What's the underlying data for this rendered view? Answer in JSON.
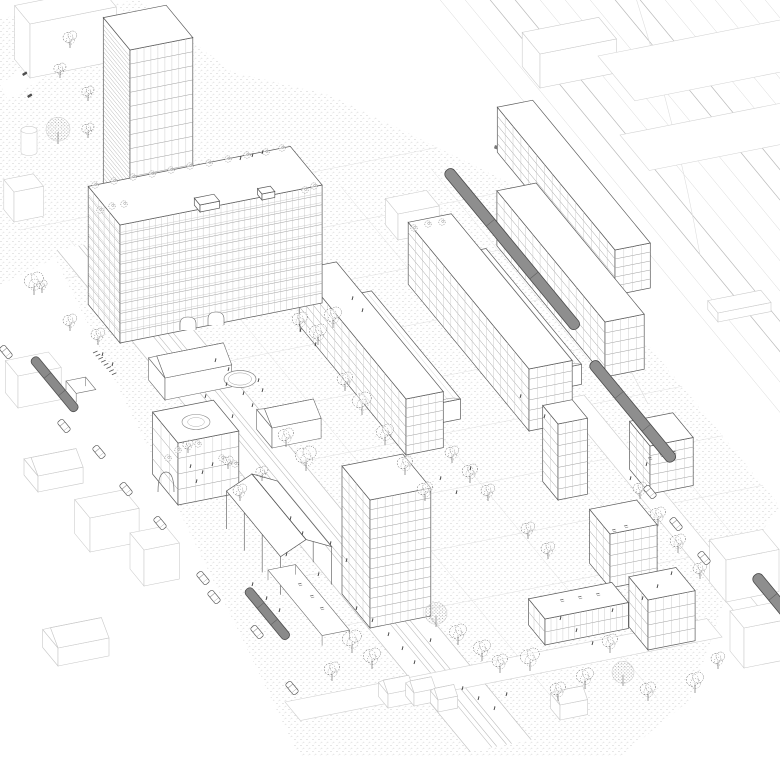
{
  "colors": {
    "background": "#ffffff",
    "ink": "#4a4a4a",
    "grid_ink": "#a8a8a8",
    "light_ink": "#c9c9c9",
    "ground_dot": "#bdbdbd",
    "vehicle_fill": "#8e8e8e",
    "vehicle_edge": "#4a4a4a",
    "tree_ink": "#565656"
  },
  "scene": {
    "ground": {
      "site_polygon": "0,18 140,0 232,72 330,95 520,188 780,506 735,570 690,700 620,757 300,757 55,258 0,285",
      "rail_count": 14,
      "rail_x0": 432,
      "rail_spacing": 25
    },
    "buildings": [
      {
        "n": "context-building-nw",
        "t": "box",
        "f": [
          30,
          78
        ],
        "a": 88,
        "b": 24,
        "h": 54,
        "ctx": 1
      },
      {
        "n": "context-silo",
        "t": "cyl",
        "f": [
          29,
          152
        ],
        "r": 8,
        "h": 22,
        "ctx": 1
      },
      {
        "n": "context-building-w1",
        "t": "box",
        "f": [
          14,
          222
        ],
        "a": 30,
        "b": 16,
        "h": 30,
        "ctx": 1
      },
      {
        "n": "context-building-w2",
        "t": "box",
        "f": [
          18,
          408
        ],
        "a": 44,
        "b": 20,
        "h": 32,
        "ctx": 1
      },
      {
        "n": "context-house-w",
        "t": "gable",
        "f": [
          38,
          492
        ],
        "a": 46,
        "b": 22,
        "h": 16,
        "rise": 10,
        "ctx": 1
      },
      {
        "n": "context-house-sw",
        "t": "gable",
        "f": [
          58,
          666
        ],
        "a": 52,
        "b": 24,
        "h": 18,
        "rise": 11,
        "ctx": 1
      },
      {
        "n": "context-building-s1",
        "t": "box",
        "f": [
          90,
          552
        ],
        "a": 50,
        "b": 24,
        "h": 34,
        "ctx": 1
      },
      {
        "n": "context-building-s2",
        "t": "box",
        "f": [
          144,
          586
        ],
        "a": 36,
        "b": 22,
        "h": 36,
        "ctx": 1
      },
      {
        "n": "context-building-n",
        "t": "box",
        "f": [
          398,
          240
        ],
        "a": 42,
        "b": 20,
        "h": 26,
        "ctx": 1
      },
      {
        "n": "context-building-ne1",
        "t": "box",
        "f": [
          540,
          88
        ],
        "a": 78,
        "b": 28,
        "h": 34,
        "ctx": 1
      },
      {
        "n": "context-roof-ne1",
        "t": "flat",
        "f": [
          598,
          56
        ],
        "a": 215,
        "b": 58,
        "ctx": 1
      },
      {
        "n": "context-roof-ne2",
        "t": "flat",
        "f": [
          620,
          135
        ],
        "a": 170,
        "b": 46,
        "ctx": 1
      },
      {
        "n": "railway-platform",
        "t": "box",
        "f": [
          718,
          322
        ],
        "a": 54,
        "b": 16,
        "h": 9,
        "ctx": 1
      },
      {
        "n": "context-building-e1",
        "t": "box",
        "f": [
          726,
          602
        ],
        "a": 54,
        "b": 26,
        "h": 42,
        "ctx": 1
      },
      {
        "n": "context-building-e2",
        "t": "box",
        "f": [
          744,
          668
        ],
        "a": 44,
        "b": 22,
        "h": 40,
        "ctx": 1
      },
      {
        "n": "context-house-s1",
        "t": "gable",
        "f": [
          388,
          708
        ],
        "a": 26,
        "b": 15,
        "h": 14,
        "rise": 8,
        "ctx": 1
      },
      {
        "n": "context-house-s2",
        "t": "gable",
        "f": [
          414,
          706
        ],
        "a": 22,
        "b": 13,
        "h": 13,
        "rise": 7,
        "ctx": 1
      },
      {
        "n": "context-house-s3",
        "t": "gable",
        "f": [
          438,
          712
        ],
        "a": 20,
        "b": 12,
        "h": 12,
        "rise": 7,
        "ctx": 1
      },
      {
        "n": "context-house-s4",
        "t": "gable",
        "f": [
          560,
          720
        ],
        "a": 28,
        "b": 15,
        "h": 15,
        "rise": 8,
        "ctx": 1
      },
      {
        "n": "slab-d-building",
        "t": "box",
        "f": [
          615,
          295
        ],
        "a": 36,
        "b": 185,
        "h": 45,
        "fl": 5,
        "cw": 9
      },
      {
        "n": "slab-c-building",
        "t": "box",
        "f": [
          605,
          377
        ],
        "a": 40,
        "b": 170,
        "h": 55,
        "fl": 5,
        "cw": 8
      },
      {
        "n": "vault-hall-bc",
        "t": "vault",
        "f": [
          558,
          389
        ],
        "a": 24,
        "b": 150,
        "h": 20
      },
      {
        "n": "slab-b-building",
        "t": "box",
        "f": [
          529,
          431
        ],
        "a": 44,
        "b": 190,
        "h": 62,
        "fl": 6,
        "cw": 8
      },
      {
        "n": "vault-hall-ab",
        "t": "vault",
        "f": [
          435,
          424
        ],
        "a": 26,
        "b": 140,
        "h": 20
      },
      {
        "n": "slab-a-building",
        "t": "box",
        "f": [
          406,
          455
        ],
        "a": 38,
        "b": 168,
        "h": 56,
        "fl": 6,
        "cw": 8
      },
      {
        "n": "highrise-tower",
        "t": "box",
        "f": [
          130,
          318
        ],
        "a": 64,
        "b": 42,
        "h": 268,
        "fl": 19,
        "cw": 7,
        "bandsL": 4.5
      },
      {
        "n": "midrise-slab-building",
        "t": "box",
        "f": [
          120,
          343
        ],
        "a": 206,
        "b": 50,
        "h": 118,
        "fl": 12,
        "cw": 6,
        "band": 1
      },
      {
        "n": "existing-hall-1",
        "t": "gable",
        "f": [
          165,
          400
        ],
        "a": 68,
        "b": 26,
        "h": 22,
        "rise": 12
      },
      {
        "n": "existing-hall-2",
        "t": "gable",
        "f": [
          272,
          448
        ],
        "a": 50,
        "b": 24,
        "h": 20,
        "rise": 10
      },
      {
        "n": "courtyard-building",
        "t": "box",
        "f": [
          178,
          505
        ],
        "a": 62,
        "b": 40,
        "h": 62,
        "fl": 4,
        "cw": 9
      },
      {
        "n": "block-c2-building",
        "t": "box",
        "f": [
          650,
          494
        ],
        "a": 44,
        "b": 32,
        "h": 48,
        "fl": 5,
        "cw": 8
      },
      {
        "n": "block-g2-building",
        "t": "box",
        "f": [
          558,
          500
        ],
        "a": 30,
        "b": 24,
        "h": 76,
        "fl": 7,
        "cw": 8
      },
      {
        "n": "block-g1-building",
        "t": "box",
        "f": [
          610,
          588
        ],
        "a": 48,
        "b": 32,
        "h": 54,
        "fl": 5,
        "cw": 8
      },
      {
        "n": "plaza-tower-building",
        "t": "box",
        "f": [
          370,
          628
        ],
        "a": 62,
        "b": 44,
        "h": 128,
        "fl": 13,
        "cw": 8
      },
      {
        "n": "low-hall-building",
        "t": "box",
        "f": [
          545,
          645
        ],
        "a": 85,
        "b": 26,
        "h": 26,
        "fl": 2,
        "cw": 6
      },
      {
        "n": "cube-building-se",
        "t": "box",
        "f": [
          648,
          650
        ],
        "a": 48,
        "b": 30,
        "h": 50,
        "fl": 4,
        "cw": 8
      },
      {
        "n": "roof-structure-1",
        "t": "box",
        "f": [
          200,
          212
        ],
        "a": 20,
        "b": 9,
        "h": 7
      },
      {
        "n": "roof-structure-2",
        "t": "box",
        "f": [
          262,
          200
        ],
        "a": 13,
        "b": 7,
        "h": 6
      }
    ],
    "details": {
      "fountain": {
        "cx": 240,
        "cy": 379,
        "rx": 16,
        "ry": 8.5
      },
      "roof_circle": {
        "cx": 196,
        "cy": 422,
        "rx": 14,
        "ry": 7.5
      },
      "arches": [
        [
          188,
          330
        ],
        [
          216,
          325
        ]
      ],
      "big_arch": {
        "x": 166,
        "y": 492
      },
      "pavilion": {
        "r0": [
          252,
          474
        ],
        "len": 85,
        "half": 26,
        "drop": 12,
        "colh": 38
      },
      "canopy": {
        "o": [
          268,
          560
        ],
        "a": 28,
        "b": 85
      },
      "tram_stop": {
        "o": [
          66,
          372
        ]
      },
      "bike_racks": {
        "x": 93,
        "y": 353,
        "count": 8
      },
      "signals": [
        [
          495,
          145
        ],
        [
          508,
          153
        ]
      ],
      "small_marks": [
        [
          22,
          74
        ],
        [
          27,
          96
        ]
      ]
    },
    "trains": [
      {
        "x": 447,
        "y": 170,
        "len": 205
      },
      {
        "x": 592,
        "y": 362,
        "len": 128
      },
      {
        "x": 755,
        "y": 575,
        "len": 85
      }
    ],
    "trams": [
      {
        "x": 33,
        "y": 358,
        "len": 68
      },
      {
        "x": 247,
        "y": 589,
        "len": 64
      }
    ],
    "cars": [
      [
        6,
        352
      ],
      [
        64,
        426
      ],
      [
        99,
        452
      ],
      [
        126,
        489
      ],
      [
        160,
        523
      ],
      [
        203,
        578
      ],
      [
        214,
        597
      ],
      [
        257,
        632
      ],
      [
        292,
        688
      ],
      [
        650,
        492
      ],
      [
        676,
        524
      ],
      [
        704,
        558
      ]
    ],
    "trees": [
      [
        70,
        47,
        8,
        "s"
      ],
      [
        60,
        77,
        7,
        "s"
      ],
      [
        88,
        100,
        7,
        "s"
      ],
      [
        58,
        143,
        12,
        "d"
      ],
      [
        88,
        137,
        7,
        "s"
      ],
      [
        42,
        292,
        6,
        "s"
      ],
      [
        34,
        294,
        11,
        "s"
      ],
      [
        70,
        330,
        8,
        "s"
      ],
      [
        98,
        344,
        8,
        "s"
      ],
      [
        300,
        330,
        9,
        "s"
      ],
      [
        318,
        344,
        10,
        "s"
      ],
      [
        333,
        327,
        10,
        "s"
      ],
      [
        345,
        390,
        9,
        "s"
      ],
      [
        362,
        414,
        11,
        "s"
      ],
      [
        385,
        444,
        10,
        "s"
      ],
      [
        405,
        474,
        9,
        "s"
      ],
      [
        425,
        500,
        9,
        "s"
      ],
      [
        306,
        470,
        12,
        "s"
      ],
      [
        286,
        446,
        9,
        "s"
      ],
      [
        262,
        480,
        7,
        "s"
      ],
      [
        240,
        500,
        8,
        "s"
      ],
      [
        452,
        462,
        8,
        "s"
      ],
      [
        470,
        482,
        9,
        "s"
      ],
      [
        488,
        500,
        8,
        "s"
      ],
      [
        352,
        652,
        11,
        "s"
      ],
      [
        332,
        680,
        9,
        "s"
      ],
      [
        372,
        668,
        10,
        "s"
      ],
      [
        436,
        626,
        11,
        "d"
      ],
      [
        458,
        644,
        10,
        "s"
      ],
      [
        482,
        660,
        10,
        "s"
      ],
      [
        500,
        672,
        9,
        "s"
      ],
      [
        530,
        670,
        11,
        "s"
      ],
      [
        558,
        700,
        9,
        "s"
      ],
      [
        585,
        688,
        10,
        "s"
      ],
      [
        610,
        652,
        9,
        "s"
      ],
      [
        623,
        685,
        11,
        "d"
      ],
      [
        648,
        700,
        9,
        "s"
      ],
      [
        695,
        692,
        10,
        "s"
      ],
      [
        718,
        668,
        8,
        "s"
      ],
      [
        658,
        525,
        9,
        "s"
      ],
      [
        678,
        552,
        9,
        "s"
      ],
      [
        700,
        578,
        8,
        "s"
      ],
      [
        640,
        498,
        8,
        "s"
      ],
      [
        528,
        538,
        8,
        "s"
      ],
      [
        548,
        558,
        8,
        "s"
      ],
      [
        188,
        452,
        6,
        "s"
      ],
      [
        228,
        468,
        6,
        "s"
      ]
    ],
    "shrubs": [
      [
        95,
        185
      ],
      [
        114,
        181
      ],
      [
        133,
        177
      ],
      [
        152,
        174
      ],
      [
        171,
        170
      ],
      [
        190,
        166
      ],
      [
        209,
        163
      ],
      [
        228,
        159
      ],
      [
        247,
        155
      ],
      [
        266,
        152
      ],
      [
        282,
        148
      ],
      [
        100,
        210
      ],
      [
        112,
        206
      ],
      [
        124,
        204
      ],
      [
        305,
        190
      ],
      [
        314,
        186
      ],
      [
        168,
        458
      ],
      [
        178,
        450
      ],
      [
        198,
        444
      ],
      [
        222,
        458
      ],
      [
        235,
        464
      ],
      [
        414,
        228
      ],
      [
        428,
        224
      ],
      [
        442,
        222
      ]
    ],
    "roof_marks": [
      [
        648,
        458
      ],
      [
        660,
        455
      ],
      [
        672,
        452
      ],
      [
        612,
        530
      ],
      [
        624,
        526
      ],
      [
        560,
        600
      ],
      [
        578,
        597
      ],
      [
        596,
        594
      ],
      [
        298,
        584
      ],
      [
        310,
        596
      ],
      [
        320,
        608
      ]
    ],
    "people": [
      [
        215,
        362
      ],
      [
        228,
        371
      ],
      [
        243,
        395
      ],
      [
        252,
        407
      ],
      [
        232,
        418
      ],
      [
        205,
        398
      ],
      [
        258,
        382
      ],
      [
        226,
        386
      ],
      [
        262,
        392
      ],
      [
        300,
        332
      ],
      [
        315,
        346
      ],
      [
        352,
        300
      ],
      [
        362,
        312
      ],
      [
        290,
        520
      ],
      [
        302,
        535
      ],
      [
        286,
        556
      ],
      [
        330,
        545
      ],
      [
        346,
        562
      ],
      [
        318,
        576
      ],
      [
        356,
        610
      ],
      [
        372,
        622
      ],
      [
        388,
        636
      ],
      [
        402,
        650
      ],
      [
        414,
        664
      ],
      [
        430,
        642
      ],
      [
        440,
        480
      ],
      [
        456,
        494
      ],
      [
        470,
        470
      ],
      [
        190,
        468
      ],
      [
        202,
        474
      ],
      [
        212,
        466
      ],
      [
        196,
        483
      ],
      [
        266,
        600
      ],
      [
        279,
        612
      ],
      [
        252,
        586
      ],
      [
        462,
        690
      ],
      [
        478,
        700
      ],
      [
        494,
        710
      ],
      [
        506,
        696
      ],
      [
        560,
        620
      ],
      [
        576,
        632
      ],
      [
        592,
        645
      ],
      [
        612,
        612
      ],
      [
        642,
        600
      ],
      [
        657,
        588
      ],
      [
        671,
        575
      ],
      [
        630,
        480
      ],
      [
        646,
        466
      ],
      [
        544,
        418
      ],
      [
        520,
        398
      ],
      [
        102,
        356
      ],
      [
        112,
        366
      ],
      [
        240,
        160
      ],
      [
        252,
        157
      ],
      [
        262,
        154
      ]
    ]
  }
}
